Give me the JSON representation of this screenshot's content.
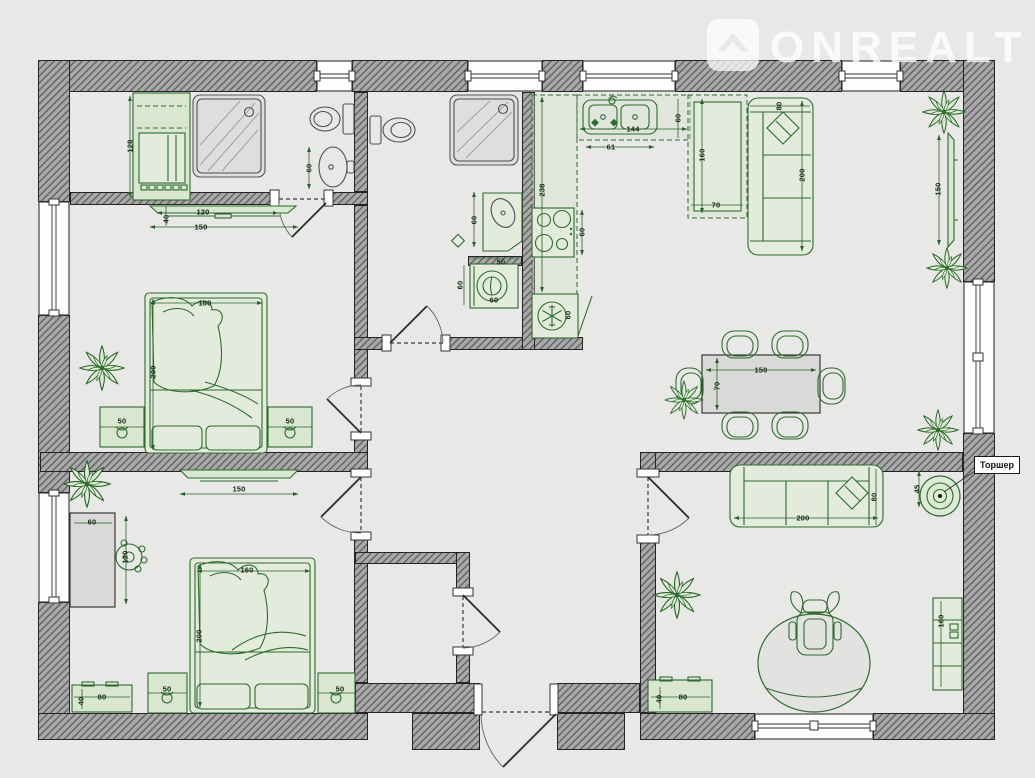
{
  "watermark": {
    "brand": "ONREALT",
    "logo": "house-shield-icon"
  },
  "callout": {
    "floor_lamp_label": "Торшер"
  },
  "colors": {
    "furniture_green": "#2e6b2e",
    "wall_gray": "#a8a8a8",
    "floor": "#e8e8e6",
    "fixture_gray": "#4f4f4f"
  },
  "dims": {
    "closet_column_height": "128",
    "tv_stand_b1_width": "120",
    "tv_stand_b1_depth": "40",
    "tv_stand_b1_total": "150",
    "bath1_sink_offset": "60",
    "bed1_width": "180",
    "bed1_length": "200",
    "bed1_nightstand_left": "50",
    "bed1_nightstand_right": "50",
    "bath2_vanity_width": "60",
    "washer_width": "50",
    "washer_side": "60",
    "washer_front": "60",
    "kitchen_counter_length": "238",
    "stove_width": "60",
    "fridge_width": "60",
    "sink_counter_length": "144",
    "sink_width": "61",
    "sink_counter_depth": "60",
    "counter2_length": "160",
    "counter2_width": "70",
    "sofa_living_depth": "80",
    "sofa_living_length": "200",
    "tv_living_width": "150",
    "dining_table_length": "150",
    "dining_table_width": "70",
    "floor_lamp_diameter": "45",
    "sofa_lounge_depth": "80",
    "sofa_lounge_length": "200",
    "shelf_height": "160",
    "dresser_lounge_width": "80",
    "dresser_lounge_depth": "40",
    "tv_b2_width": "150",
    "desk_width": "60",
    "desk_length": "120",
    "bed2_width": "160",
    "bed2_length": "200",
    "bed2_nightstand_left": "50",
    "bed2_nightstand_right": "50",
    "dresser_b2_width": "80",
    "dresser_b2_depth": "40"
  }
}
